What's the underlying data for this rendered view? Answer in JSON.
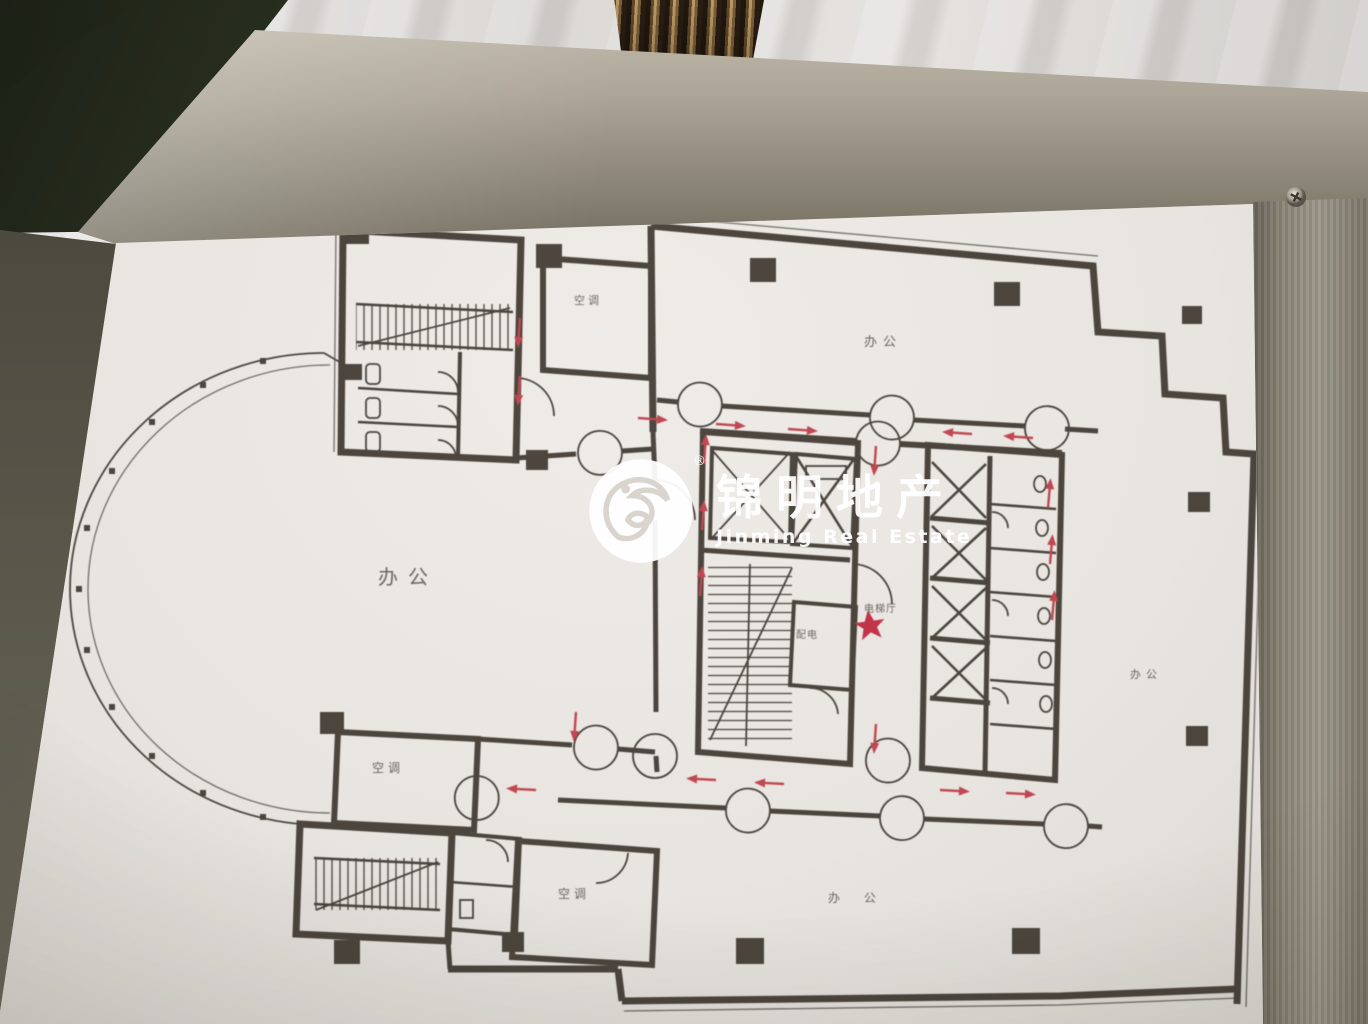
{
  "scene": {
    "description": "Photo of a framed building floor plan (evacuation plan) on a marble wall with brushed-metal frame"
  },
  "watermark": {
    "brand_cn": "锦明地产",
    "brand_en": "Jinming Real Estate",
    "registered_mark": "®"
  },
  "floorplan": {
    "labels": {
      "office_left": "办公",
      "office_top": "办公",
      "office_right": "办公",
      "office_bottom": "办 公",
      "hvac_top": "空调",
      "hvac_mid": "空调",
      "hvac_bottom": "空调",
      "power_room": "配电",
      "elevator_hall": "电梯厅"
    },
    "marker": {
      "you_are_here_star": "★"
    }
  },
  "colors": {
    "route_red": "#bf3642",
    "star_red": "#c02038",
    "ink": "#3a342c",
    "label_ink": "#4c463e",
    "watermark_white": "#ffffff"
  }
}
